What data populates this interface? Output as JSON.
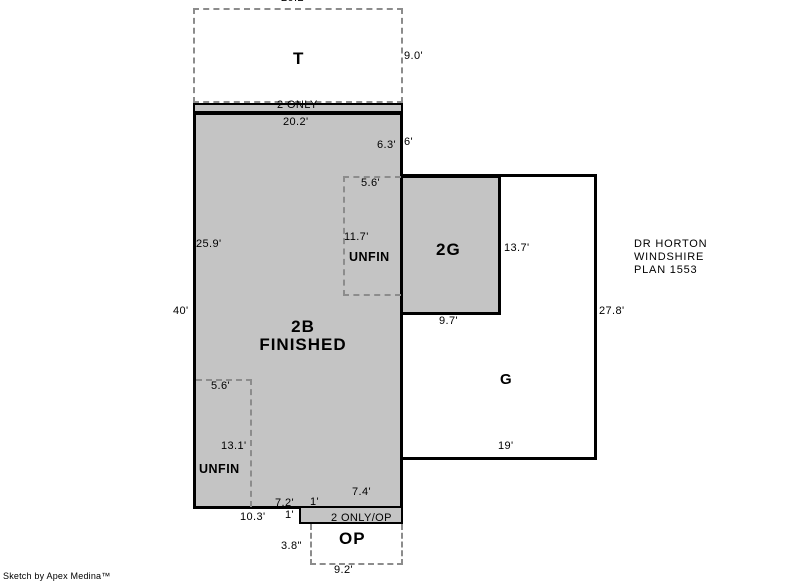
{
  "sketch": {
    "credit": "Sketch by Apex Medina™",
    "plan_note": {
      "line1": "DR HORTON",
      "line2": "WINDSHIRE",
      "line3": "PLAN 1553"
    },
    "colors": {
      "finished_fill": "#c4c4c4",
      "outline": "#000000",
      "dashed_line": "#8c8c8c"
    },
    "areas": {
      "t": {
        "name": "T",
        "width_top": "20.2'",
        "height_right": "9.0'"
      },
      "two_only": {
        "name": "2 ONLY"
      },
      "b2": {
        "name_line1": "2B",
        "name_line2": "FINISHED",
        "width_top": "20.2'",
        "height_left": "40'",
        "left_segment": "25.9'",
        "right_segment_inner": "6.3'",
        "right_segment_outer": "6'"
      },
      "unfin_upper": {
        "name": "UNFIN",
        "width_top": "5.6'",
        "height_left": "11.7'"
      },
      "unfin_lower": {
        "name": "UNFIN",
        "width_top": "5.6'",
        "height_mid": "13.1'"
      },
      "g2": {
        "name": "2G",
        "height_right": "13.7'",
        "width_bottom": "9.7'"
      },
      "g": {
        "name": "G",
        "height_right": "27.8'",
        "width_bottom": "19'"
      },
      "two_only_op": {
        "name": "2 ONLY/OP",
        "width_top": "7.4'",
        "step_top_left": "7.2'",
        "step_top_width": "1'",
        "bottom_left_segment": "10.3'",
        "step_height": "1'"
      },
      "op": {
        "name": "OP",
        "height_left": "3.8\"",
        "width_bottom": "9.2'"
      }
    }
  }
}
